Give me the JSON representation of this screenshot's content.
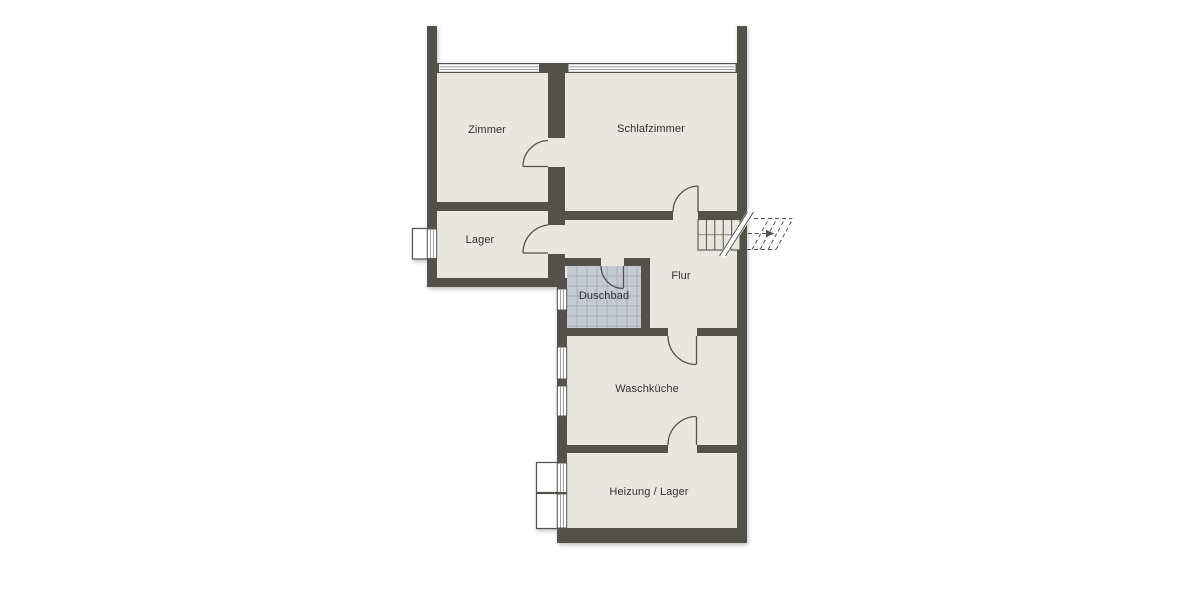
{
  "plan": {
    "type": "floor-plan",
    "rooms": [
      {
        "label": "Zimmer",
        "cx": 487,
        "cy": 130
      },
      {
        "label": "Schlafzimmer",
        "cx": 651,
        "cy": 129
      },
      {
        "label": "Lager",
        "cx": 480,
        "cy": 240
      },
      {
        "label": "Flur",
        "cx": 681,
        "cy": 276
      },
      {
        "label": "Duschbad",
        "cx": 604,
        "cy": 296
      },
      {
        "label": "Waschküche",
        "cx": 647,
        "cy": 389
      },
      {
        "label": "Heizung / Lager",
        "cx": 649,
        "cy": 492
      }
    ],
    "features": {
      "stair_direction": "out-right",
      "tiled_room": "Duschbad"
    }
  },
  "colors": {
    "background": "#ffffff",
    "wall": "#54514b",
    "floor": "#e9e6e0",
    "tile": "#c6cad2",
    "tile_grid": "#9fa5ae",
    "window": "#ffffff",
    "text": "#303034"
  }
}
